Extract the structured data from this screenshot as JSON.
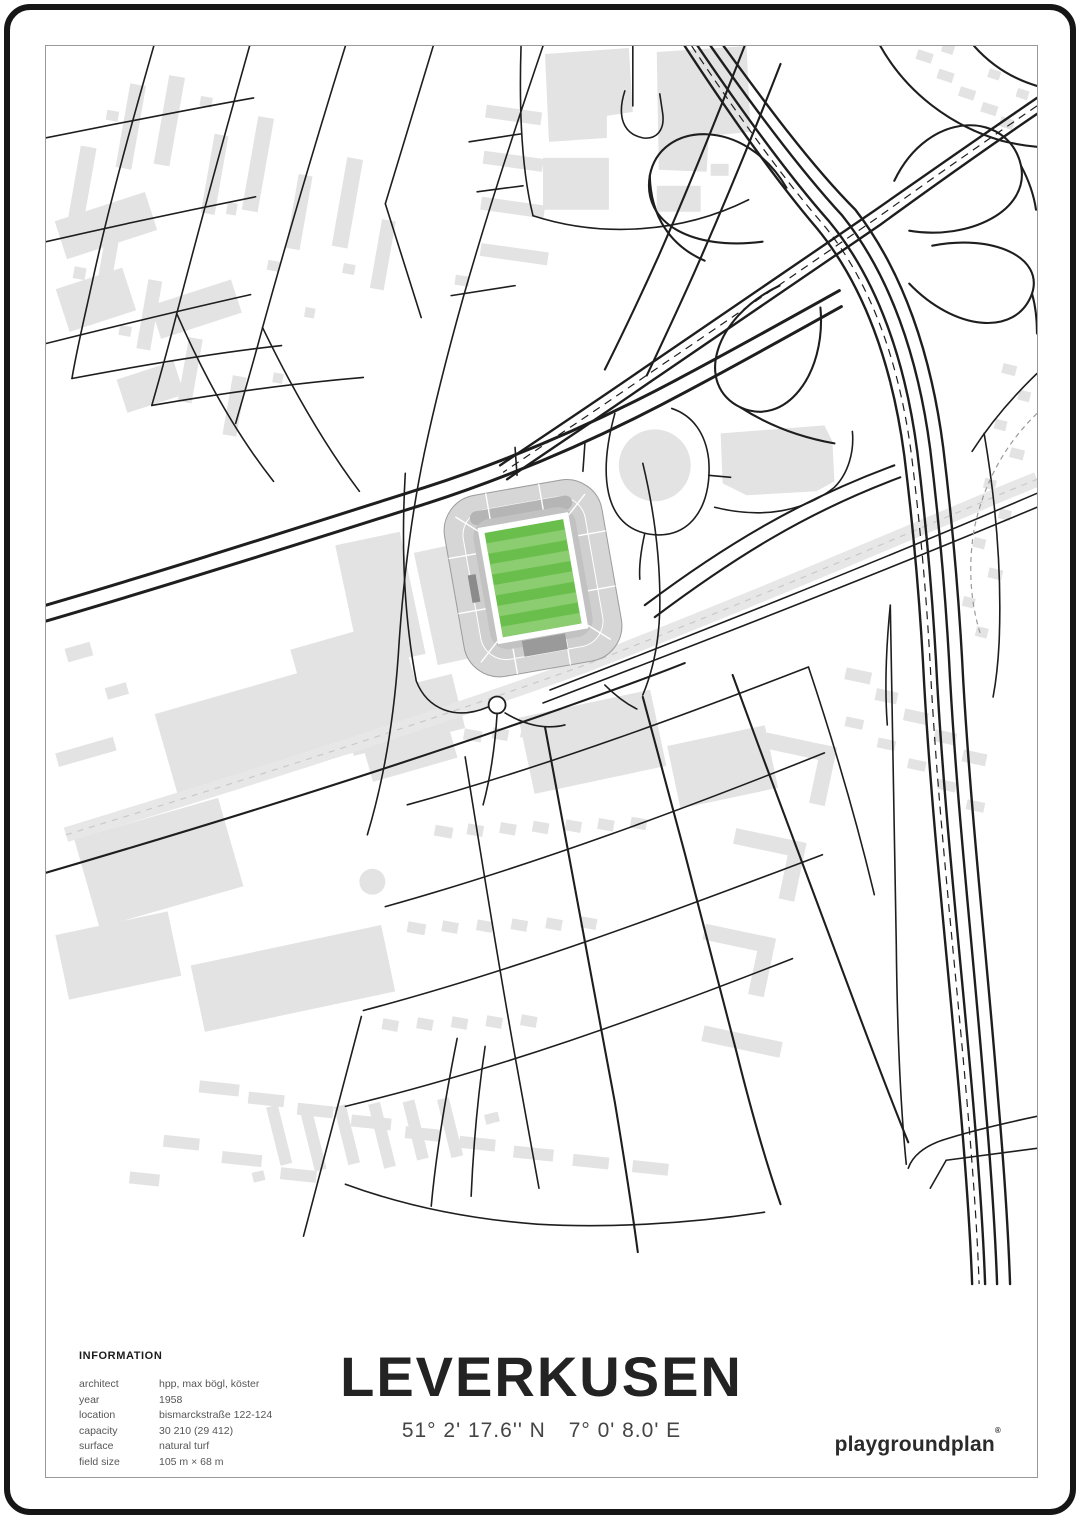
{
  "poster": {
    "title": "LEVERKUSEN",
    "coordinates": {
      "lat": "51° 2' 17.6'' N",
      "lon": "7° 0' 8.0' E"
    },
    "brand": {
      "name": "playgroundplan",
      "mark": "®"
    },
    "info": {
      "heading": "INFORMATION",
      "rows": [
        {
          "label": "architect",
          "value": "hpp, max bögl, köster"
        },
        {
          "label": "year",
          "value": "1958"
        },
        {
          "label": "location",
          "value": "bismarckstraße 122-124"
        },
        {
          "label": "capacity",
          "value": "30 210 (29 412)"
        },
        {
          "label": "surface",
          "value": "natural turf"
        },
        {
          "label": "field size",
          "value": "105 m × 68 m"
        }
      ]
    },
    "colors": {
      "pitch_green": "#6abf4c",
      "pitch_green_light": "#8bcd70",
      "building_gray": "#e3e3e3",
      "stand_gray": "#d6d6d6",
      "stand_gray_dark": "#9c9c9c",
      "road_black": "#1e1e1e",
      "railway_gray": "#e7e7e7",
      "frame_black": "#161616",
      "border_gray": "#999999",
      "text_dark": "#232323",
      "text_gray": "#555555",
      "background": "#ffffff"
    }
  }
}
